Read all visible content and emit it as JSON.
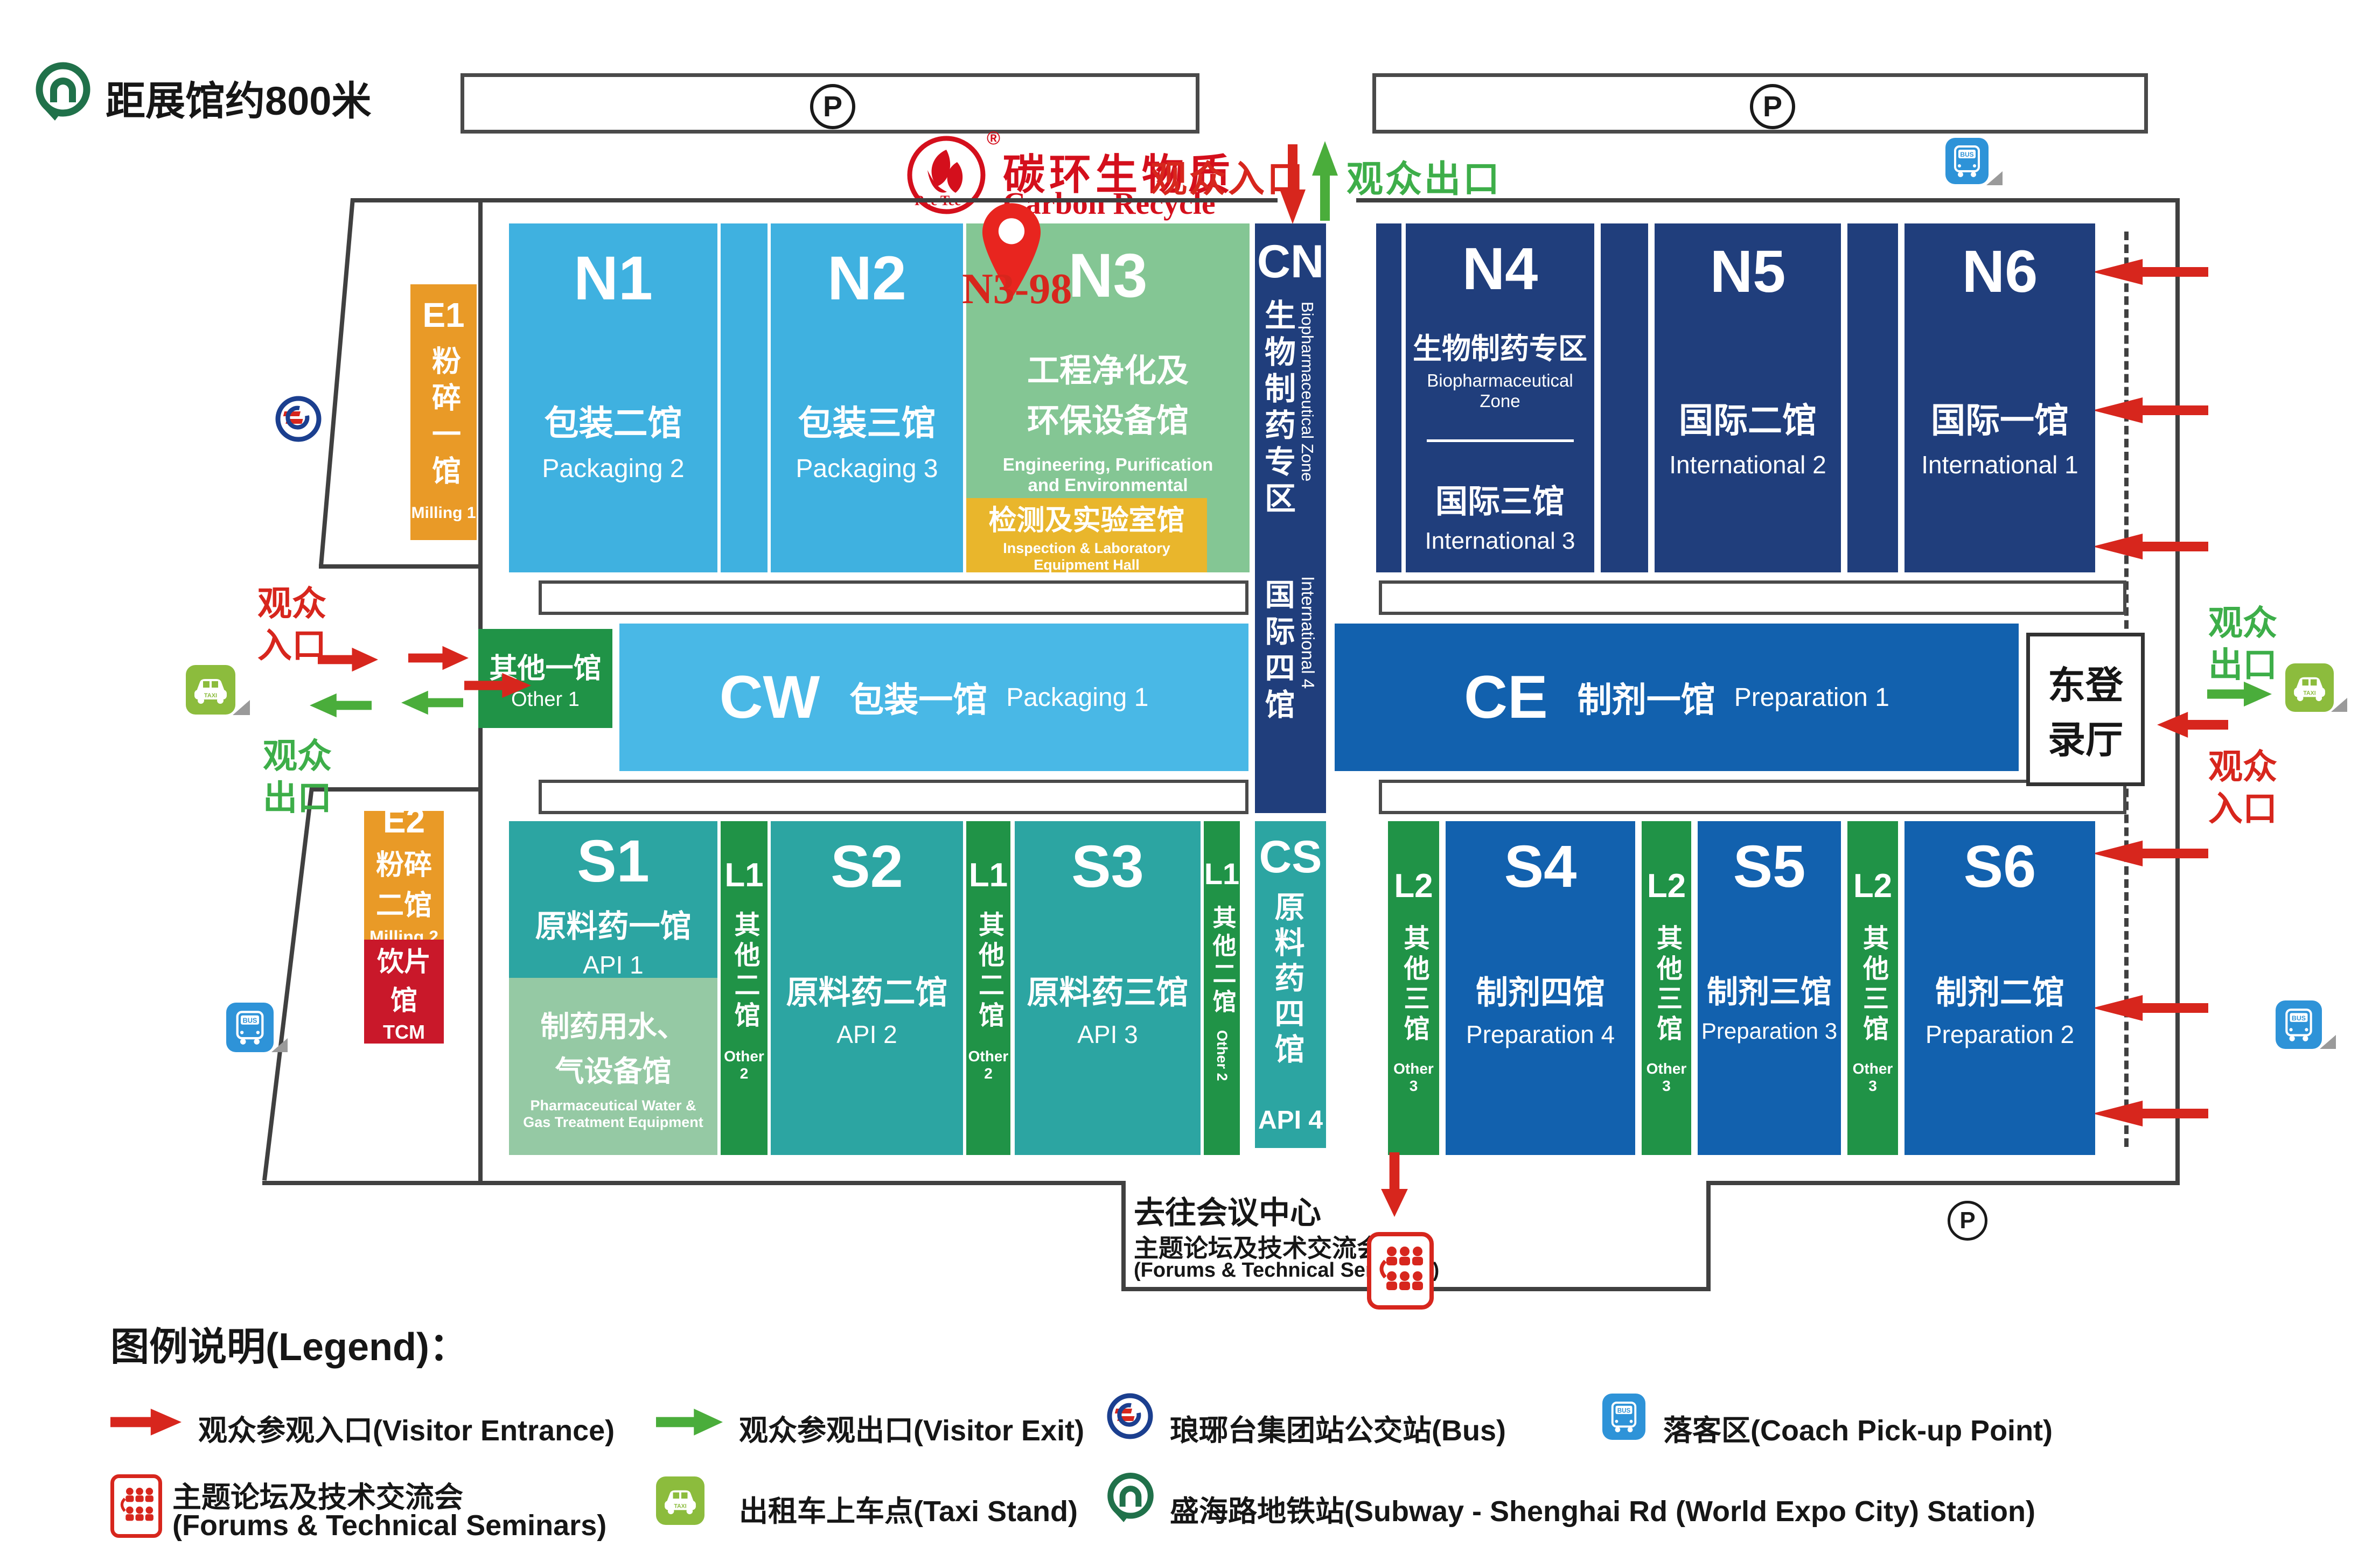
{
  "meta": {
    "distance_note": "距展馆约800米",
    "parking_symbol": "P",
    "booth_marker": "N3-98"
  },
  "watermark": {
    "cn": "碳环生物质",
    "en": "Carbon Recycle",
    "badge": "Rec Tec",
    "reg": "®"
  },
  "icons": {
    "bus_label": "BUS",
    "taxi_label": "TAXI"
  },
  "top": {
    "entrance": "观众入口",
    "exit": "观众出口"
  },
  "left_side": {
    "entrance_line1": "观众",
    "entrance_line2": "入口",
    "exit_line1": "观众",
    "exit_line2": "出口"
  },
  "right_side": {
    "exit_line1": "观众",
    "exit_line2": "出口",
    "entrance_line1": "观众",
    "entrance_line2": "入口",
    "east_hall_line1": "东登",
    "east_hall_line2": "录厅"
  },
  "halls": {
    "n1": {
      "code": "N1",
      "cn": "包装二馆",
      "en": "Packaging 2"
    },
    "n2": {
      "code": "N2",
      "cn": "包装三馆",
      "en": "Packaging 3"
    },
    "n3": {
      "code": "N3",
      "cn1": "工程净化及",
      "cn2": "环保设备馆",
      "en1": "Engineering, Purification",
      "en2": "and Environmental",
      "en3": "Protection Equipment"
    },
    "n3_sub": {
      "cn": "检测及实验室馆",
      "en1": "Inspection & Laboratory",
      "en2": "Equipment Hall"
    },
    "cn_col": {
      "code": "CN",
      "cn": "生物制药专区",
      "en": "Biopharmaceutical Zone"
    },
    "intl4": {
      "cn": "国际四馆",
      "en": "International 4"
    },
    "n4": {
      "code": "N4",
      "zone_cn": "生物制药专区",
      "zone_en": "Biopharmaceutical Zone",
      "cn": "国际三馆",
      "en": "International 3"
    },
    "n5": {
      "code": "N5",
      "cn": "国际二馆",
      "en": "International 2"
    },
    "n6": {
      "code": "N6",
      "cn": "国际一馆",
      "en": "International 1"
    },
    "cw": {
      "code": "CW",
      "cn": "包装一馆",
      "en": "Packaging 1"
    },
    "ce": {
      "code": "CE",
      "cn": "制剂一馆",
      "en": "Preparation 1"
    },
    "other1": {
      "cn": "其他一馆",
      "en": "Other 1"
    },
    "s1": {
      "code": "S1",
      "cn": "原料药一馆",
      "en": "API 1"
    },
    "s1_sub": {
      "cn1": "制药用水、",
      "cn2": "气设备馆",
      "en1": "Pharmaceutical Water &",
      "en2": "Gas Treatment Equipment"
    },
    "s2": {
      "code": "S2",
      "cn": "原料药二馆",
      "en": "API 2"
    },
    "s3": {
      "code": "S3",
      "cn": "原料药三馆",
      "en": "API 3"
    },
    "l1": {
      "code": "L1",
      "cn": "其他二馆",
      "en": "Other 2"
    },
    "cs": {
      "code": "CS",
      "cn": "原料药四馆",
      "en": "API 4"
    },
    "l2": {
      "code": "L2",
      "cn": "其他三馆",
      "en": "Other 3"
    },
    "s4": {
      "code": "S4",
      "cn": "制剂四馆",
      "en": "Preparation 4"
    },
    "s5": {
      "code": "S5",
      "cn": "制剂三馆",
      "en": "Preparation 3"
    },
    "s6": {
      "code": "S6",
      "cn": "制剂二馆",
      "en": "Preparation 2"
    },
    "e1": {
      "code": "E1",
      "cn": "粉碎一馆",
      "en": "Milling 1"
    },
    "e2": {
      "code": "E2",
      "cn1": "粉碎",
      "cn2": "二馆",
      "en": "Milling 2"
    },
    "tcm": {
      "cn": "饮片馆",
      "en": "TCM"
    }
  },
  "conference": {
    "line1": "去往会议中心",
    "line2": "主题论坛及技术交流会",
    "line3": "(Forums & Technical Seminars)"
  },
  "legend": {
    "title": "图例说明(Legend)：",
    "entrance": "观众参观入口(Visitor Entrance)",
    "exit": "观众参观出口(Visitor Exit)",
    "seminar_line1": "主题论坛及技术交流会",
    "seminar_line2": "(Forums & Technical Seminars)",
    "taxi": "出租车上车点(Taxi Stand)",
    "bus": "琅琊台集团站公交站(Bus)",
    "coach": "落客区(Coach Pick-up Point)",
    "subway": "盛海路地铁站(Subway - Shenghai Rd (World Expo City) Station)"
  },
  "colors": {
    "light_blue": "#3fb1e0",
    "cw_blue": "#49b8e6",
    "navy": "#203e7c",
    "soft_green": "#84c694",
    "yellow": "#e9b62c",
    "teal": "#2ca5a2",
    "pale_green": "#95c9a4",
    "strip_green": "#209347",
    "deep_blue": "#1261ae",
    "orange": "#e99a27",
    "tcm_red": "#c9182a",
    "arrow_red": "#d7261d",
    "arrow_green": "#4aad3b",
    "outline": "#404040",
    "watermark_red": "#d40f1c"
  }
}
